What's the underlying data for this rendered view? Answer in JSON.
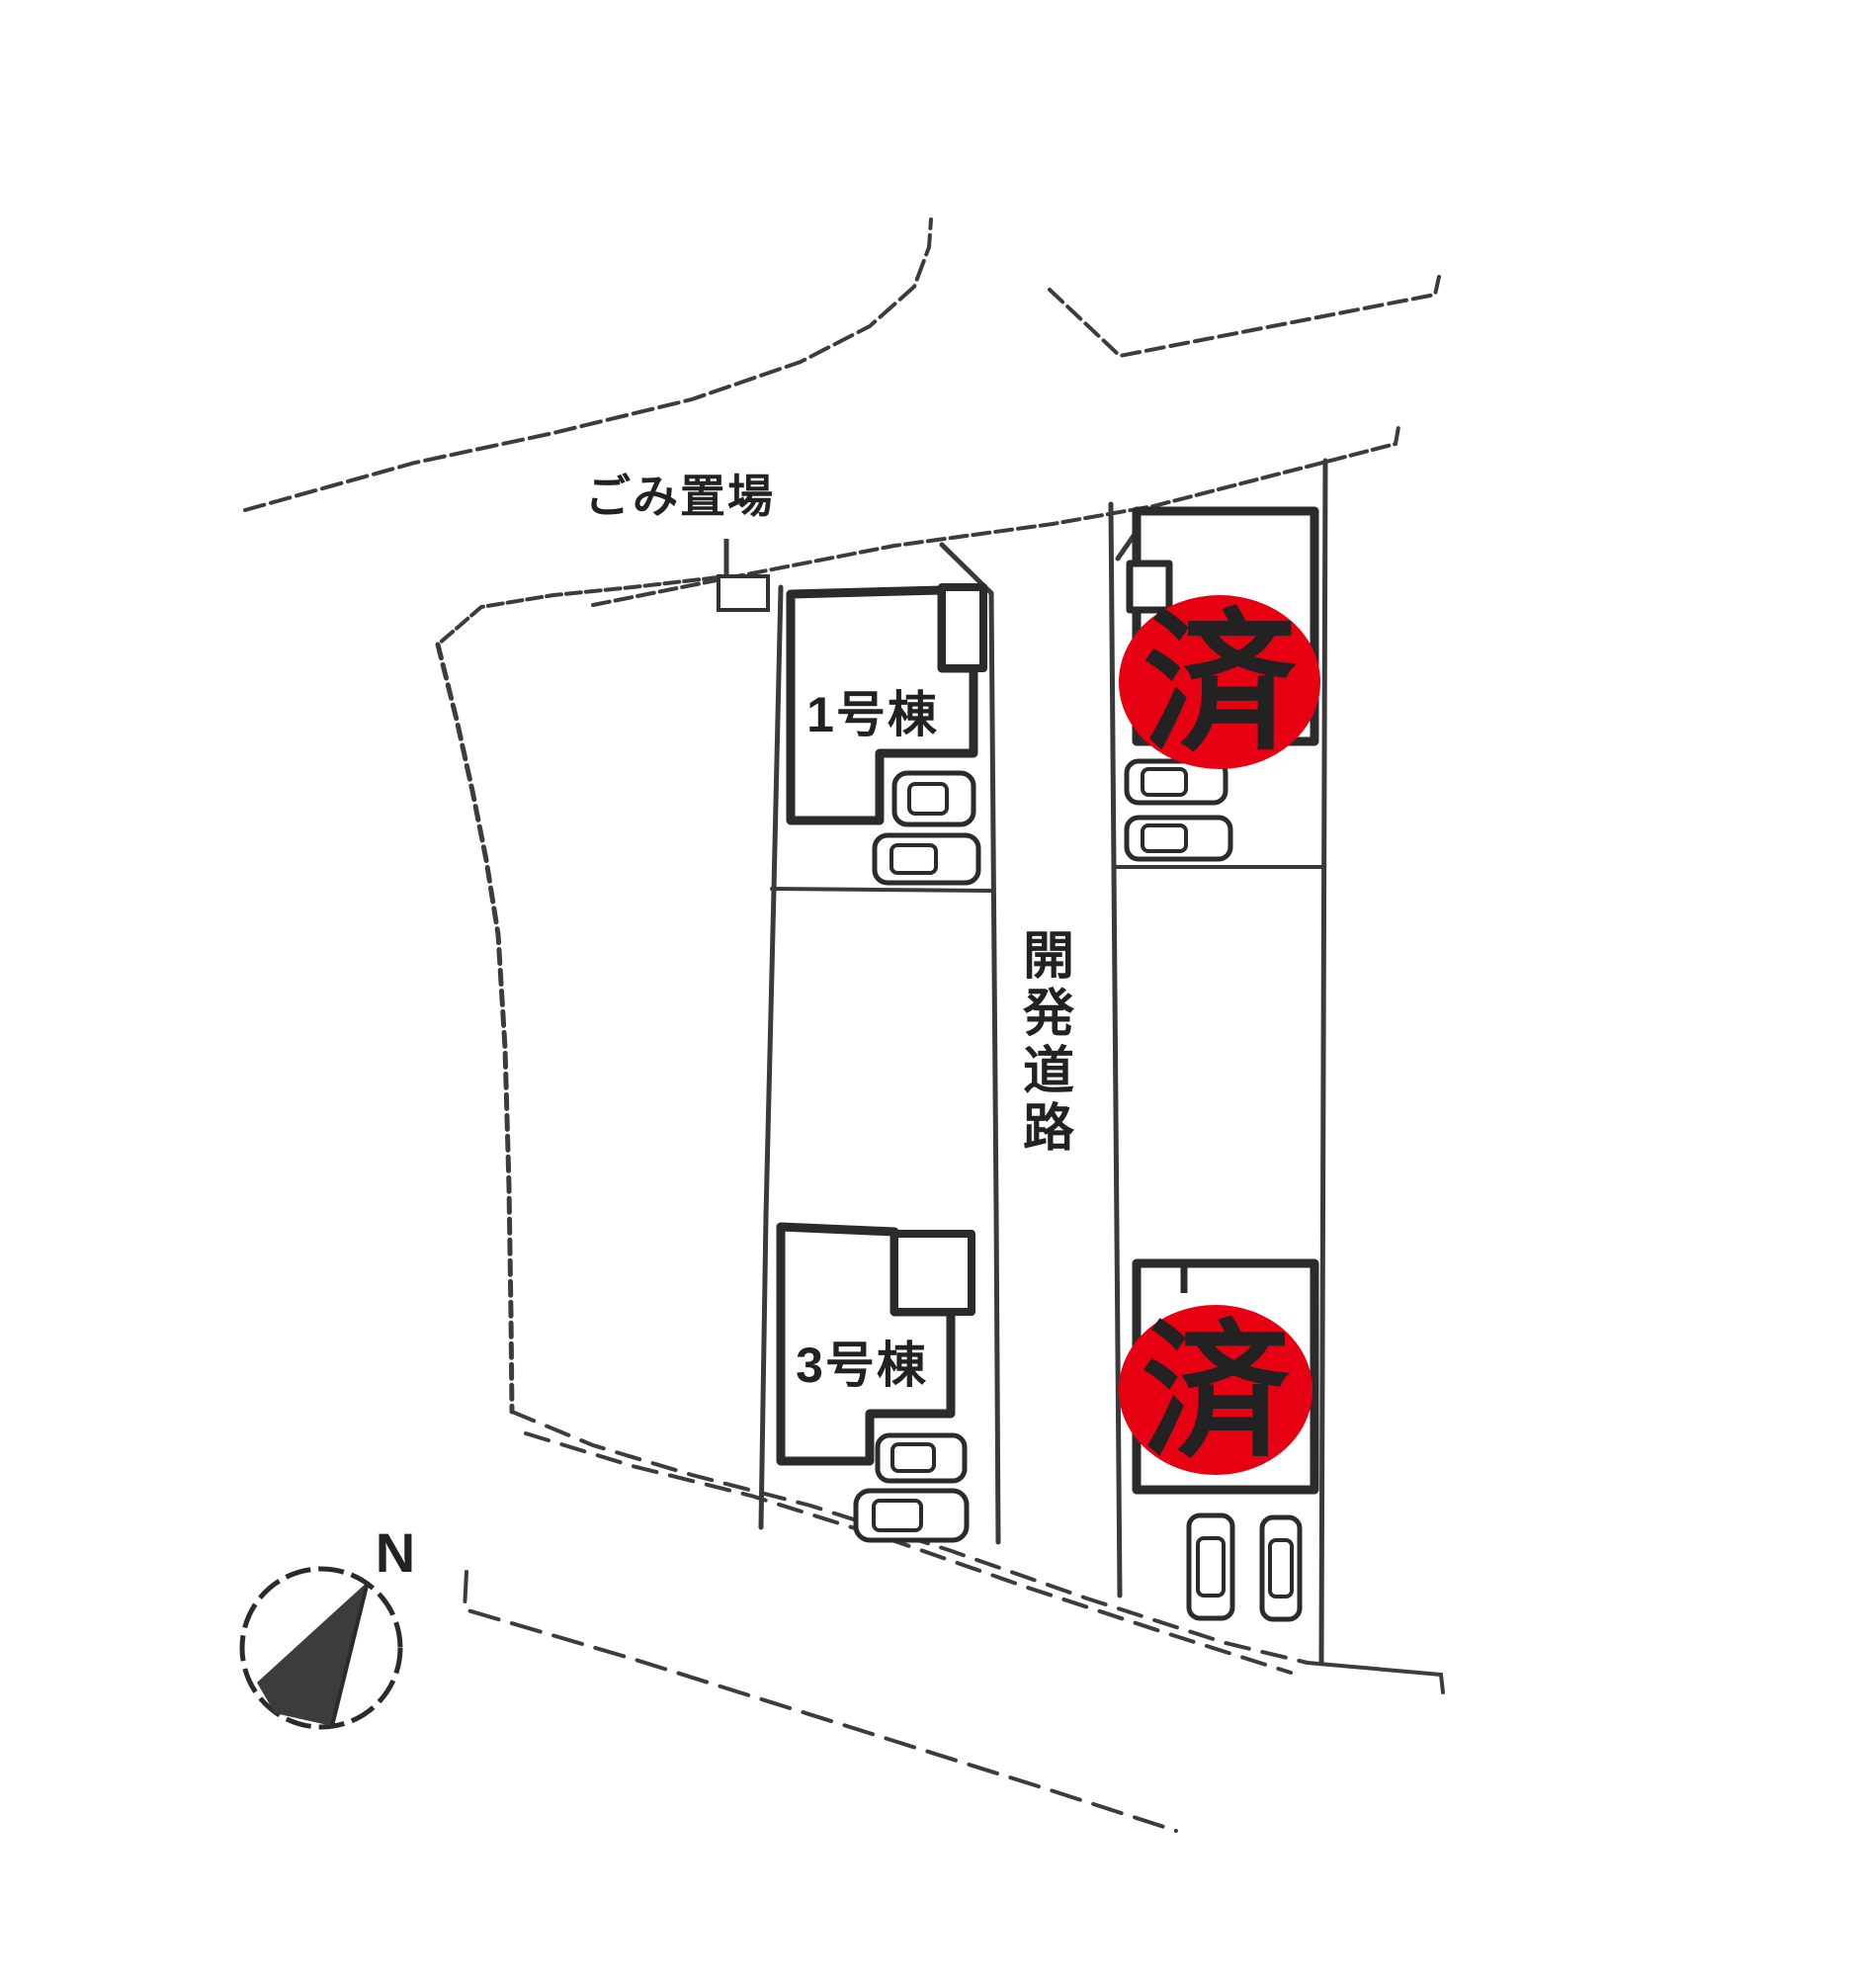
{
  "canvas": {
    "background": "#ffffff"
  },
  "colors": {
    "stamp_red": "#e60012",
    "stamp_text": "#111111",
    "ink": "#2f2f2f"
  },
  "labels": {
    "garbage": "ごみ置場",
    "road": "開発道路",
    "north": "N"
  },
  "units": [
    {
      "label": "1号棟"
    },
    {
      "label": "3号棟"
    }
  ],
  "stamps": [
    {
      "label": "済"
    },
    {
      "label": "済"
    }
  ]
}
